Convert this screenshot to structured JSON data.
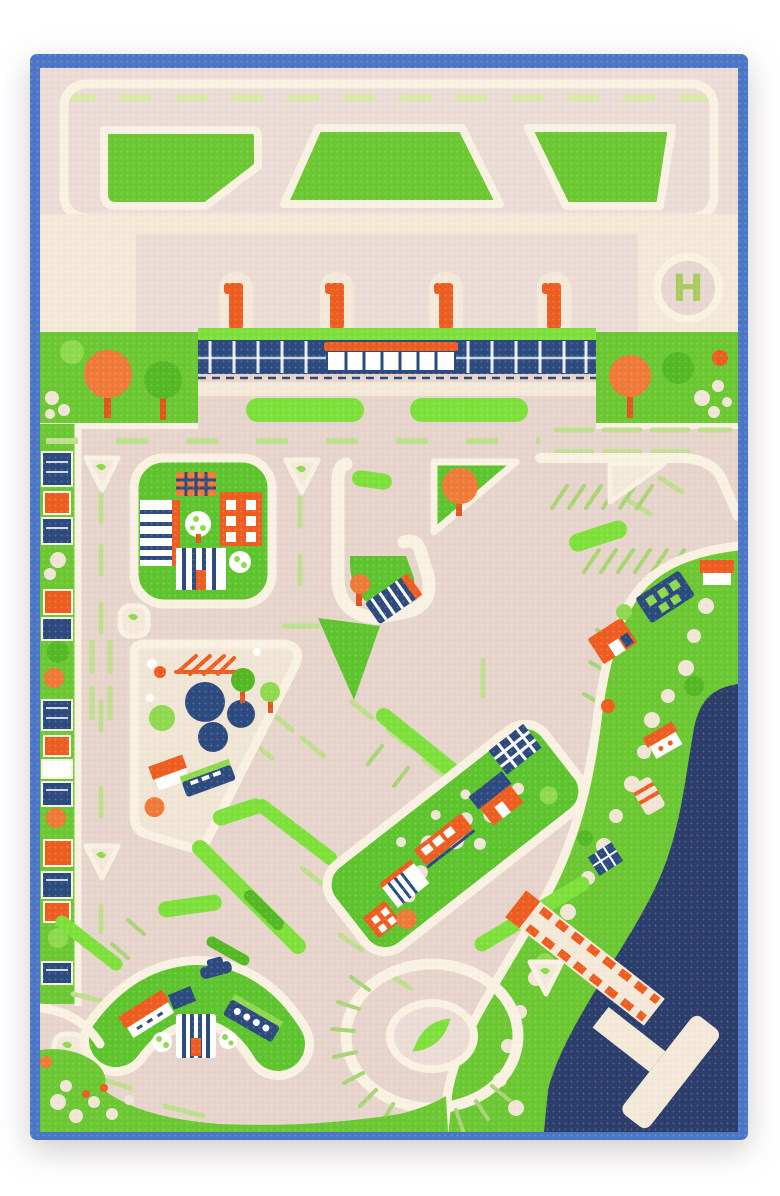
{
  "helipad": {
    "label": "H"
  },
  "palette": {
    "page_bg": "#ffffff",
    "edge_blue": "#4b76c5",
    "water_navy": "#2b3e6b",
    "apron_pink": "#ecdcd6",
    "road_beige": "#e7d5cc",
    "curb_cream": "#f9f1e1",
    "raised_cream": "#f4e9d8",
    "pebble_cream": "#f1e6d5",
    "grass_green": "#6cc832",
    "block_green": "#5ec42e",
    "hedge_bright": "#7ee03a",
    "hedge_dark": "#54b824",
    "leaf_light": "#8fd94f",
    "guide_green": "#bfdf8e",
    "stripe_green": "#a9d477",
    "runway_dash": "#d8e9a8",
    "orange": "#ee5d20",
    "orange_soft": "#f07a38",
    "navy": "#2b4a7e",
    "trunk": "#e2551c",
    "h_green": "#a9cb60",
    "white": "#ffffff",
    "taupe": "#d9c3b8"
  }
}
